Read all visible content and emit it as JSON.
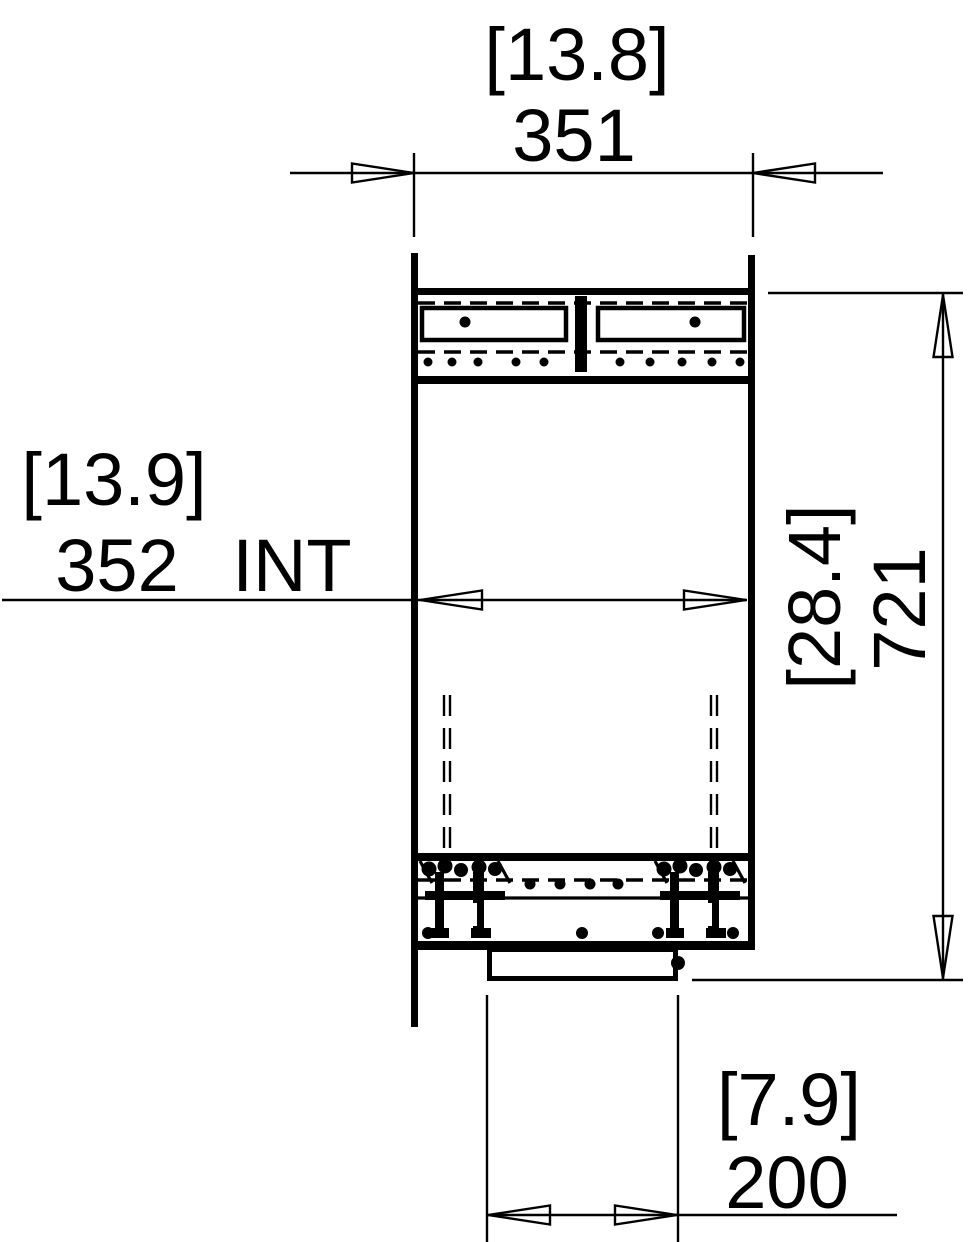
{
  "drawing": {
    "kind": "technical-section-drawing",
    "colors": {
      "line": "#000000",
      "background": "#ffffff"
    },
    "dimensions": {
      "top_width": {
        "imperial": "[13.8]",
        "metric": "351"
      },
      "internal_width": {
        "imperial": "[13.9]",
        "metric": "352",
        "suffix": "INT"
      },
      "overall_height": {
        "imperial": "[28.4]",
        "metric": "721"
      },
      "outlet_width": {
        "imperial": "[7.9]",
        "metric": "200"
      }
    }
  }
}
